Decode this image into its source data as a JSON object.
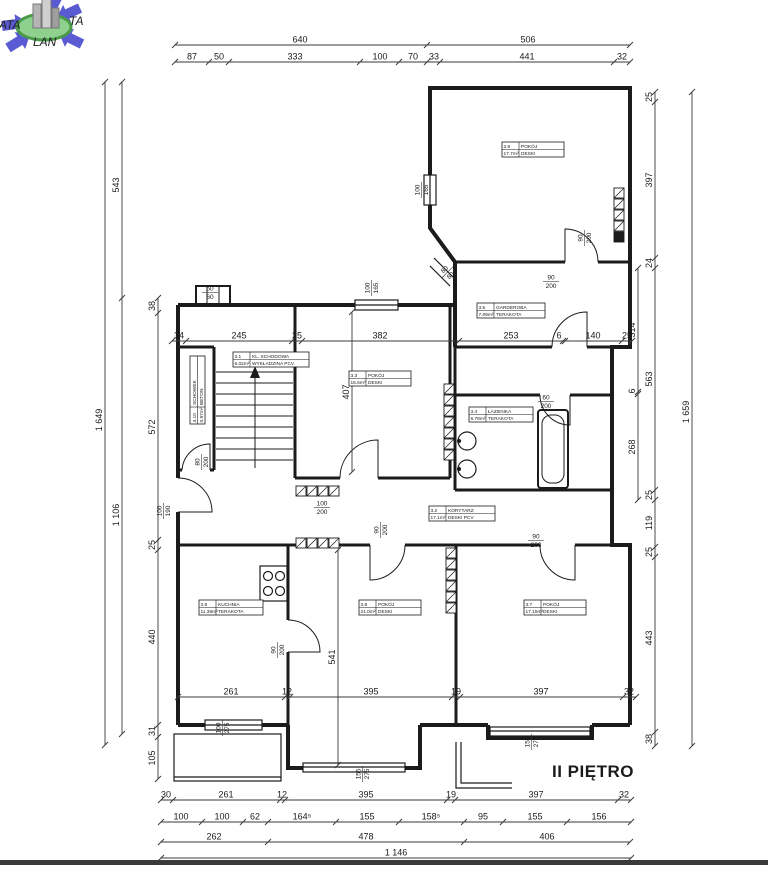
{
  "logo": {
    "text_left": "ATA",
    "text_right": "TA",
    "text_bottom": "LAN",
    "arrow_color": "#5a5ad2",
    "ellipse_fill": "#8fd08f",
    "ellipse_stroke": "#4a9a4a"
  },
  "floor_label": "II PIĘTRO",
  "colors": {
    "wall": "#1b1b1b",
    "dim_line": "#3a3a3a",
    "dim_text": "#1b1b1b"
  },
  "rooms": [
    {
      "id": "3.1",
      "name": "KL. SCHODOWA",
      "area": "6.02m²",
      "floor": "WYKŁADZINA PCV",
      "x": 233,
      "y": 352,
      "w": 76,
      "rot": 0
    },
    {
      "id": "3.2",
      "name": "KORYTARZ",
      "area": "17.1m²",
      "floor": "DESKI PCV",
      "x": 429,
      "y": 506,
      "w": 66,
      "rot": 0
    },
    {
      "id": "3.3",
      "name": "POKÓJ",
      "area": "15.5m²",
      "floor": "DESKI",
      "x": 349,
      "y": 371,
      "w": 62,
      "rot": 0
    },
    {
      "id": "3.4",
      "name": "ŁAZIENKA",
      "area": "6.78m²",
      "floor": "TERAKOTA",
      "x": 469,
      "y": 407,
      "w": 64,
      "rot": 0
    },
    {
      "id": "3.5",
      "name": "GARDEROBA",
      "area": "7.09m²",
      "floor": "TERAKOTA",
      "x": 477,
      "y": 303,
      "w": 68,
      "rot": 0
    },
    {
      "id": "3.6",
      "name": "POKÓJ",
      "area": "17.7m²",
      "floor": "DESKI",
      "x": 502,
      "y": 142,
      "w": 62,
      "rot": 0
    },
    {
      "id": "3.7",
      "name": "POKÓJ",
      "area": "17.15m²",
      "floor": "DESKI",
      "x": 524,
      "y": 600,
      "w": 62,
      "rot": 0
    },
    {
      "id": "3.8",
      "name": "POKÓJ",
      "area": "21.0m²",
      "floor": "DESKI",
      "x": 359,
      "y": 600,
      "w": 62,
      "rot": 0
    },
    {
      "id": "3.9",
      "name": "KUCHNIA",
      "area": "11.36m²",
      "floor": "TERAKOTA",
      "x": 199,
      "y": 600,
      "w": 64,
      "rot": 0
    },
    {
      "id": "3.10",
      "name": "SCHOWEK",
      "area": "0.97m²",
      "floor": "BETON",
      "x": 190,
      "y": 424,
      "w": 68,
      "rot": -90
    }
  ],
  "dim_chains": [
    {
      "dir": "h",
      "pos": 45,
      "from": 175,
      "to": 630,
      "ticks": [
        175,
        427,
        630
      ],
      "labels": [
        {
          "t": "640",
          "p": 300
        },
        {
          "t": "506",
          "p": 528
        }
      ]
    },
    {
      "dir": "h",
      "pos": 62,
      "from": 175,
      "to": 630,
      "ticks": [
        175,
        209,
        229,
        360,
        399,
        427,
        440,
        614,
        630
      ],
      "labels": [
        {
          "t": "87",
          "p": 192
        },
        {
          "t": "50",
          "p": 219
        },
        {
          "t": "333",
          "p": 295
        },
        {
          "t": "100",
          "p": 380
        },
        {
          "t": "70",
          "p": 413
        },
        {
          "t": "33",
          "p": 434
        },
        {
          "t": "441",
          "p": 527
        },
        {
          "t": "32",
          "p": 622
        }
      ]
    },
    {
      "dir": "h",
      "pos": 341,
      "from": 172,
      "to": 632,
      "ticks": [
        172,
        186,
        292,
        302,
        459,
        563,
        565,
        622,
        632
      ],
      "labels": [
        {
          "t": "34",
          "p": 179
        },
        {
          "t": "245",
          "p": 239
        },
        {
          "t": "25",
          "p": 297
        },
        {
          "t": "382",
          "p": 380
        },
        {
          "t": "253",
          "p": 511
        },
        {
          "t": "6",
          "p": 559
        },
        {
          "t": "140",
          "p": 593
        },
        {
          "t": "25",
          "p": 627
        }
      ]
    },
    {
      "dir": "h",
      "pos": 697,
      "from": 178,
      "to": 636,
      "ticks": [
        178,
        285,
        290,
        452,
        460,
        623,
        636
      ],
      "labels": [
        {
          "t": "261",
          "p": 231
        },
        {
          "t": "12",
          "p": 287
        },
        {
          "t": "395",
          "p": 371
        },
        {
          "t": "19",
          "p": 456
        },
        {
          "t": "397",
          "p": 541
        },
        {
          "t": "32",
          "p": 629
        }
      ]
    },
    {
      "dir": "h",
      "pos": 800,
      "from": 161,
      "to": 631,
      "ticks": [
        161,
        173,
        280,
        285,
        447,
        455,
        618,
        631
      ],
      "labels": [
        {
          "t": "30",
          "p": 166
        },
        {
          "t": "261",
          "p": 226
        },
        {
          "t": "12",
          "p": 282
        },
        {
          "t": "395",
          "p": 366
        },
        {
          "t": "19",
          "p": 451
        },
        {
          "t": "397",
          "p": 536
        },
        {
          "t": "32",
          "p": 624
        }
      ]
    },
    {
      "dir": "h",
      "pos": 822,
      "from": 161,
      "to": 631,
      "ticks": [
        161,
        202,
        243,
        268,
        336,
        399,
        464,
        503,
        567,
        631
      ],
      "labels": [
        {
          "t": "100",
          "p": 181
        },
        {
          "t": "100",
          "p": 222
        },
        {
          "t": "62",
          "p": 255
        },
        {
          "t": "164⁵",
          "p": 302
        },
        {
          "t": "155",
          "p": 367
        },
        {
          "t": "158⁵",
          "p": 431
        },
        {
          "t": "95",
          "p": 483
        },
        {
          "t": "155",
          "p": 535
        },
        {
          "t": "156",
          "p": 599
        }
      ]
    },
    {
      "dir": "h",
      "pos": 842,
      "from": 161,
      "to": 630,
      "ticks": [
        161,
        268,
        464,
        630
      ],
      "labels": [
        {
          "t": "262",
          "p": 214
        },
        {
          "t": "478",
          "p": 366
        },
        {
          "t": "406",
          "p": 547
        }
      ]
    },
    {
      "dir": "h",
      "pos": 858,
      "from": 161,
      "to": 631,
      "ticks": [
        161,
        631
      ],
      "labels": [
        {
          "t": "1 146",
          "p": 396
        }
      ]
    },
    {
      "dir": "v",
      "pos": 655,
      "from": 92,
      "to": 746,
      "ticks": [
        92,
        102,
        258,
        268,
        490,
        500,
        547,
        557,
        732,
        746
      ],
      "labels": [
        {
          "t": "25",
          "p": 97
        },
        {
          "t": "397",
          "p": 180
        },
        {
          "t": "24",
          "p": 263
        },
        {
          "t": "563",
          "p": 379
        },
        {
          "t": "25",
          "p": 495
        },
        {
          "t": "119",
          "p": 523
        },
        {
          "t": "25",
          "p": 552
        },
        {
          "t": "443",
          "p": 638
        },
        {
          "t": "38",
          "p": 739
        }
      ]
    },
    {
      "dir": "v",
      "pos": 638,
      "from": 268,
      "to": 500,
      "ticks": [
        268,
        392,
        394,
        500
      ],
      "labels": [
        {
          "t": "314",
          "p": 330
        },
        {
          "t": "6",
          "p": 391
        },
        {
          "t": "268",
          "p": 447
        }
      ]
    },
    {
      "dir": "v",
      "pos": 692,
      "from": 92,
      "to": 746,
      "ticks": [
        92,
        746
      ],
      "labels": [
        {
          "t": "1 659",
          "p": 412
        }
      ]
    },
    {
      "dir": "v",
      "pos": 105,
      "from": 82,
      "to": 745,
      "ticks": [
        82,
        745
      ],
      "labels": [
        {
          "t": "1 649",
          "p": 420
        }
      ]
    },
    {
      "dir": "v",
      "pos": 122,
      "from": 82,
      "to": 734,
      "ticks": [
        82,
        298,
        734
      ],
      "labels": [
        {
          "t": "543",
          "p": 185
        },
        {
          "t": "1 106",
          "p": 515
        }
      ]
    },
    {
      "dir": "v",
      "pos": 158,
      "from": 298,
      "to": 779,
      "ticks": [
        298,
        313,
        540,
        550,
        725,
        737,
        779
      ],
      "labels": [
        {
          "t": "38",
          "p": 306
        },
        {
          "t": "572",
          "p": 427
        },
        {
          "t": "25",
          "p": 545
        },
        {
          "t": "440",
          "p": 637
        },
        {
          "t": "31",
          "p": 731
        },
        {
          "t": "105",
          "p": 758
        }
      ]
    },
    {
      "dir": "v",
      "pos": 352,
      "from": 312,
      "to": 472,
      "ticks": [
        312,
        472
      ],
      "labels": [
        {
          "t": "407",
          "p": 392
        }
      ]
    },
    {
      "dir": "v",
      "pos": 338,
      "from": 550,
      "to": 765,
      "ticks": [
        550,
        765
      ],
      "labels": [
        {
          "t": "541",
          "p": 657
        }
      ]
    }
  ],
  "openings": [
    {
      "w": "100",
      "h": "165",
      "x": 421,
      "y": 190,
      "rot": -90
    },
    {
      "w": "100",
      "h": "165",
      "x": 371,
      "y": 288,
      "rot": -90
    },
    {
      "w": "50",
      "h": "60",
      "x": 210,
      "y": 292,
      "rot": 0
    },
    {
      "w": "90",
      "h": "200",
      "x": 584,
      "y": 238,
      "rot": -90
    },
    {
      "w": "90",
      "h": "200",
      "x": 551,
      "y": 281,
      "rot": 0
    },
    {
      "w": "80",
      "h": "80",
      "x": 447,
      "y": 272,
      "rot": -45
    },
    {
      "w": "80",
      "h": "200",
      "x": 201,
      "y": 462,
      "rot": -90
    },
    {
      "w": "100",
      "h": "190",
      "x": 163,
      "y": 511,
      "rot": -90
    },
    {
      "w": "100",
      "h": "200",
      "x": 322,
      "y": 507,
      "rot": 0
    },
    {
      "w": "90",
      "h": "200",
      "x": 380,
      "y": 530,
      "rot": -90
    },
    {
      "w": "60",
      "h": "200",
      "x": 546,
      "y": 401,
      "rot": 0
    },
    {
      "w": "90",
      "h": "200",
      "x": 536,
      "y": 540,
      "rot": 0
    },
    {
      "w": "90",
      "h": "200",
      "x": 277,
      "y": 650,
      "rot": -90
    },
    {
      "w": "100",
      "h": "275",
      "x": 222,
      "y": 728,
      "rot": -90
    },
    {
      "w": "155",
      "h": "275",
      "x": 362,
      "y": 774,
      "rot": -90
    },
    {
      "w": "155",
      "h": "275",
      "x": 531,
      "y": 742,
      "rot": -90
    }
  ]
}
